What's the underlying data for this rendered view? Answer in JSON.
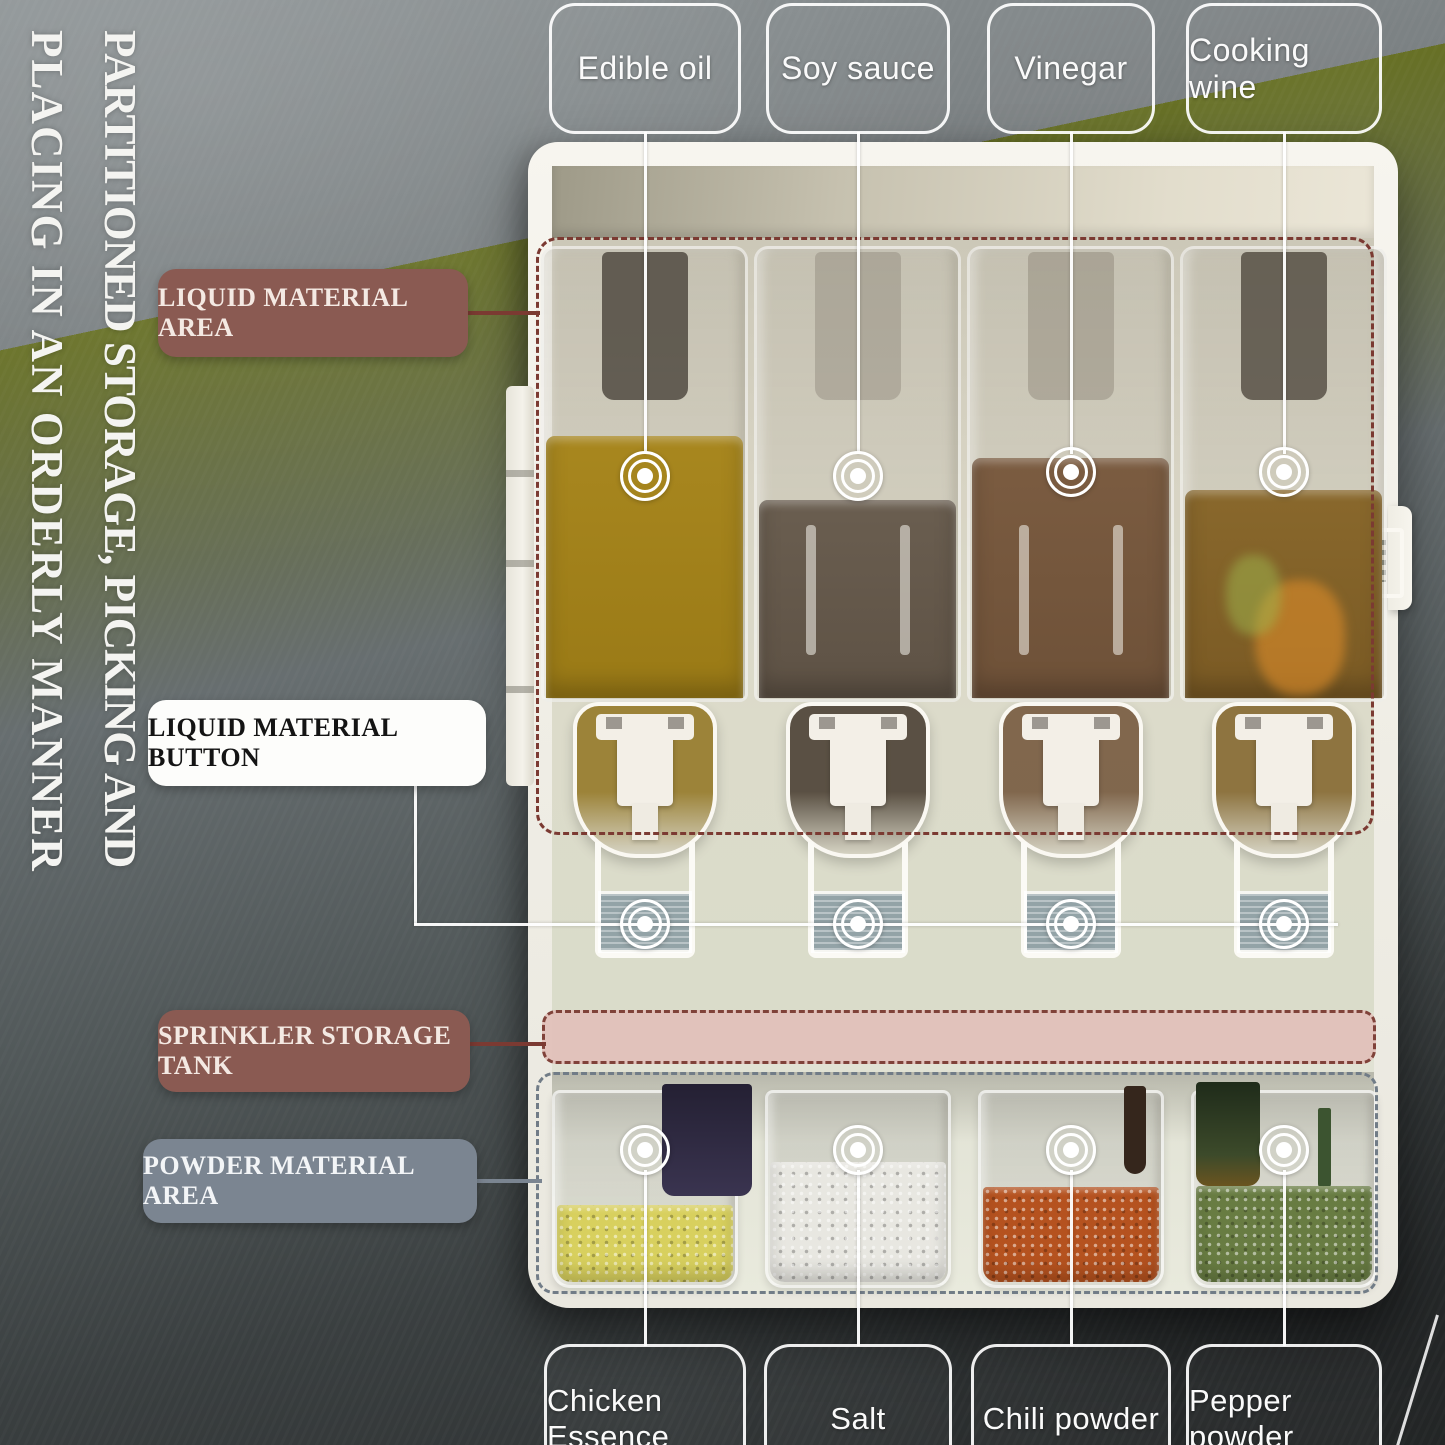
{
  "side_title": {
    "line1": "PARTITIONED STORAGE, PICKING AND",
    "line2": "PLACING IN AN ORDERLY MANNER"
  },
  "top_labels": {
    "items": [
      {
        "label": "Edible oil"
      },
      {
        "label": "Soy sauce"
      },
      {
        "label": "Vinegar"
      },
      {
        "label": "Cooking wine"
      }
    ]
  },
  "callouts": {
    "liquid_area": "LIQUID MATERIAL AREA",
    "liquid_button": "LIQUID MATERIAL BUTTON",
    "sprinkler_tank": "SPRINKLER STORAGE TANK",
    "powder_area": "POWDER MATERIAL AREA"
  },
  "bottom_labels": {
    "items": [
      {
        "label": "Chicken Essence"
      },
      {
        "label": "Salt"
      },
      {
        "label": "Chili powder"
      },
      {
        "label": "Pepper powder"
      }
    ]
  },
  "colors": {
    "oil": "#9a7a16",
    "soy_sauce": "#5e5245",
    "vinegar": "#6e5138",
    "cooking_wine": "#7a5a24",
    "chicken_essence": "#d8d05e",
    "salt": "#e8e7e1",
    "chili_powder": "#b5521f",
    "pepper_powder": "#687c42",
    "liquid_label_bg": "#8a5a52",
    "sprinkler_label_bg": "#8a5a54",
    "powder_label_bg": "#7b8591",
    "annotation_line_maroon": "#7b3a32",
    "powder_dash": "#717c87",
    "pink_tank": "#e2c1ba"
  }
}
